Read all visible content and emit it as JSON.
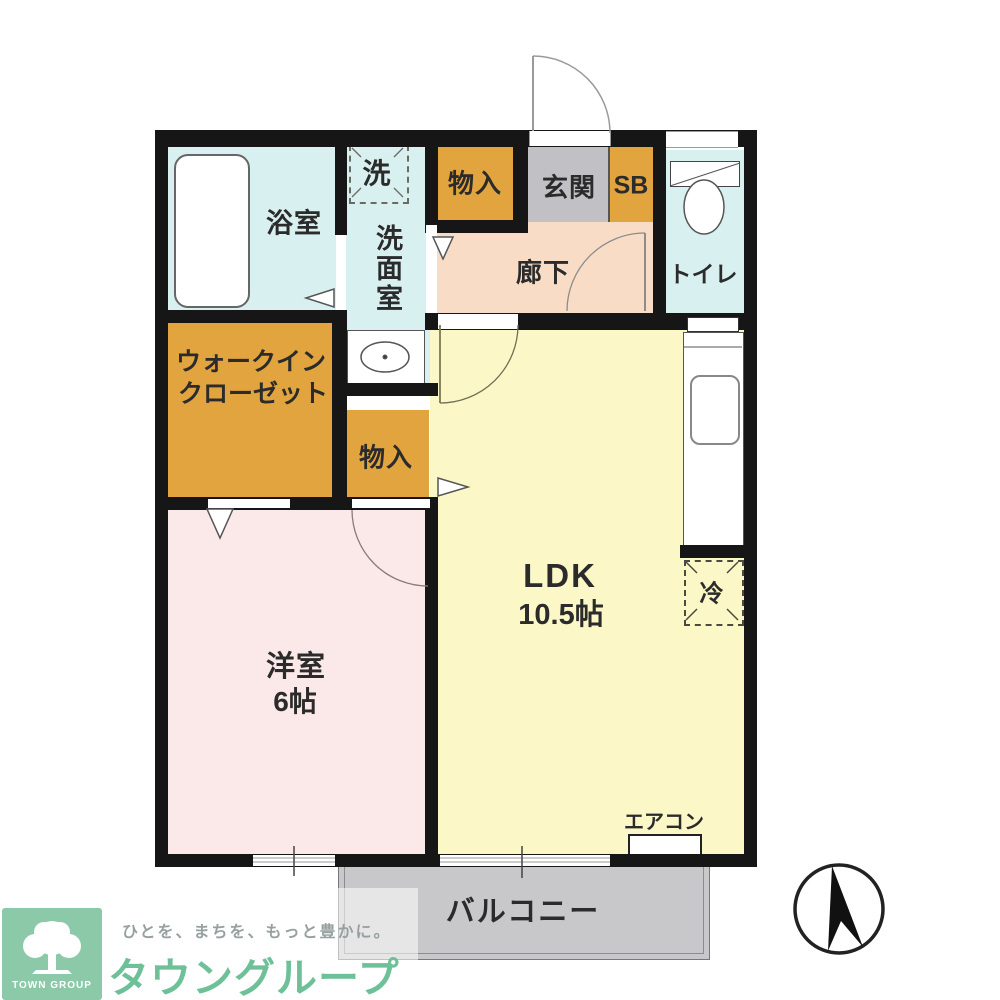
{
  "plan": {
    "rooms": {
      "bath": "浴室",
      "washer": "洗",
      "washroom": "洗面室",
      "storage_top": "物入",
      "entrance": "玄関",
      "shoe_box": "SB",
      "toilet": "トイレ",
      "hallway": "廊下",
      "wic_line1": "ウォークイン",
      "wic_line2": "クローゼット",
      "storage_mid": "物入",
      "ldk_name": "LDK",
      "ldk_size": "10.5帖",
      "fridge": "冷",
      "bedroom_name": "洋室",
      "bedroom_size": "6帖",
      "aircon": "エアコン",
      "balcony": "バルコニー"
    },
    "colors": {
      "wall": "#161616",
      "water": "#d9f0f1",
      "hall": "#f8dcc6",
      "ldk": "#fbf7c6",
      "bedroom": "#fbe9e9",
      "storage": "#e2a43e",
      "entry": "#c1c0c4",
      "balcony": "#c8c8cb",
      "brand_green": "#6ec098",
      "tagline_gray": "#97a0a0"
    },
    "logo": {
      "badge": "TOWN GROUP",
      "tagline": "ひとを、まちを、もっと豊かに。",
      "brand": "タウングループ"
    }
  }
}
